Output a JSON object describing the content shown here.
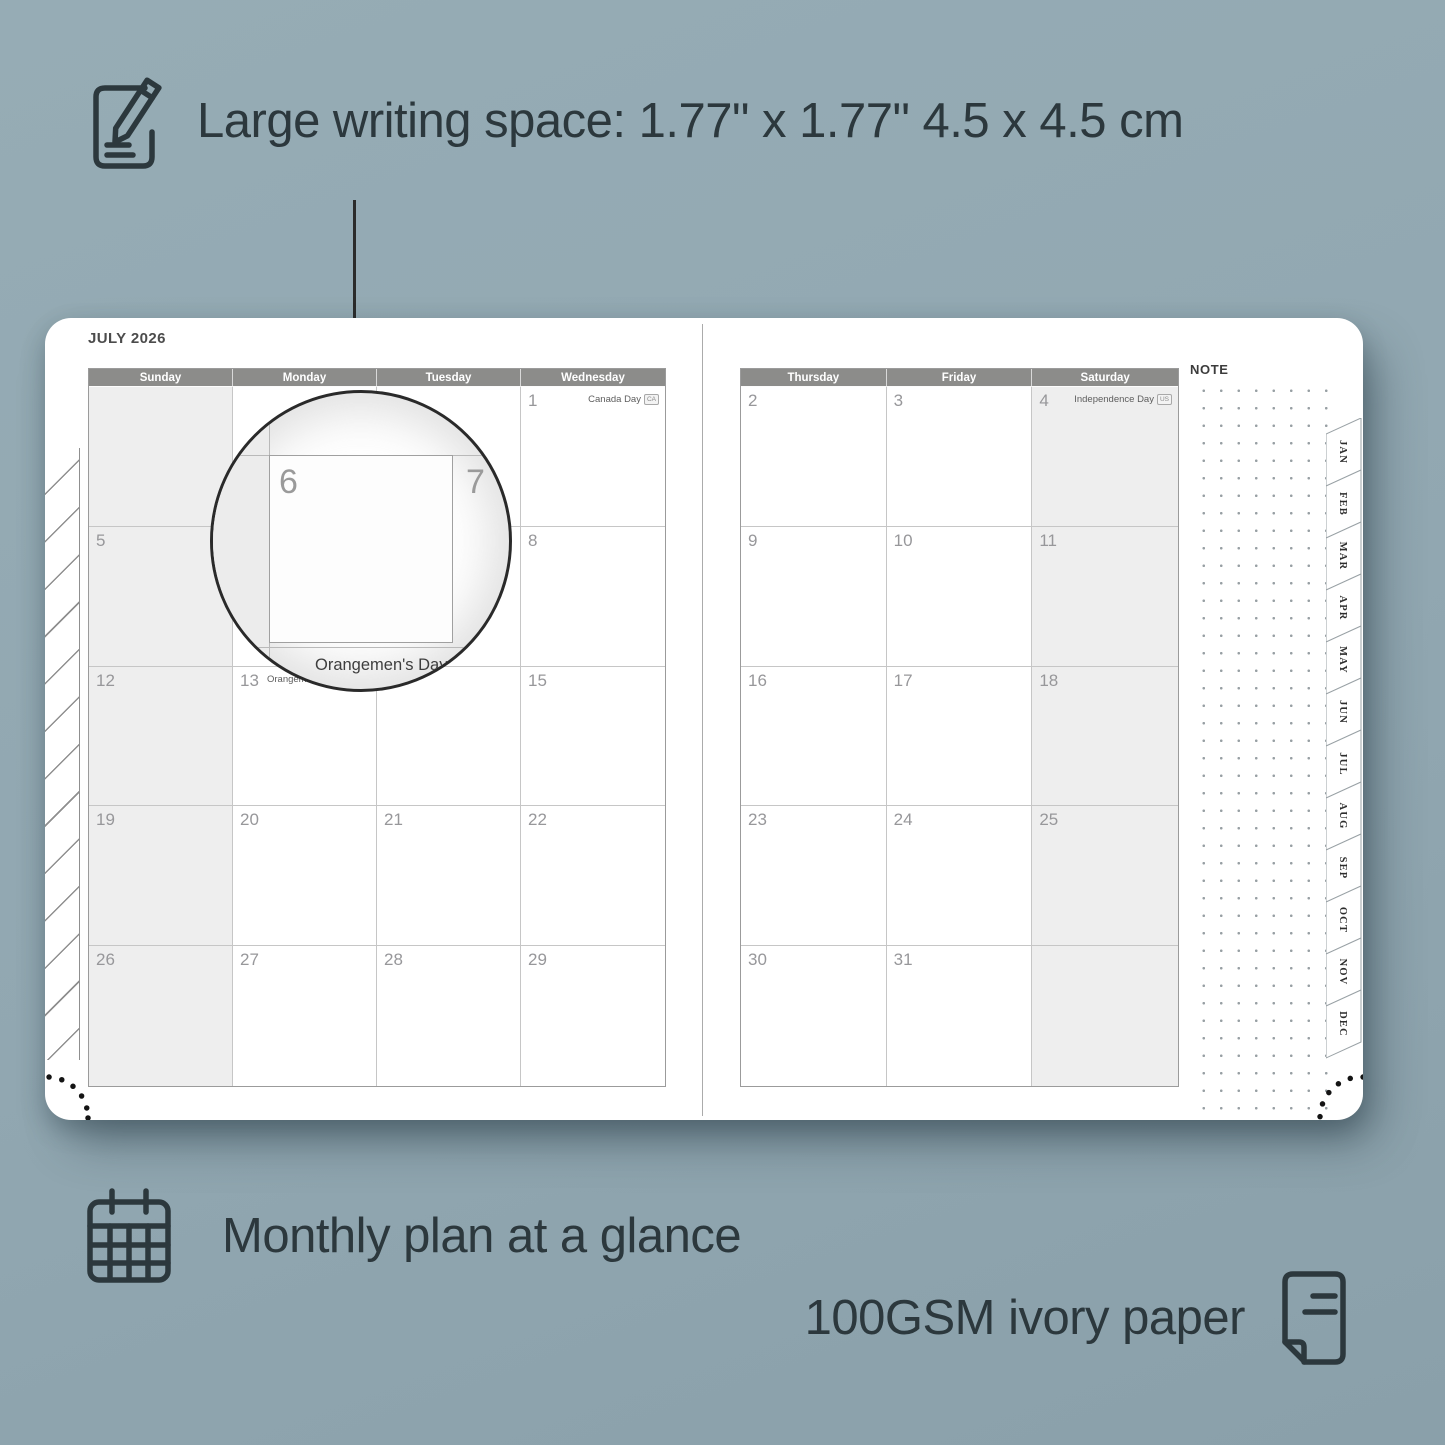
{
  "colors": {
    "background": "#91a7b1",
    "page": "#ffffff",
    "header_bar": "#8c8c8a",
    "shaded_cell": "#eeeeee",
    "grid_line": "#c6c6c6",
    "annotation_text": "#2c383d",
    "day_number": "#97979a"
  },
  "annotations": {
    "writing_space": "Large writing space: 1.77\" x 1.77\" 4.5 x 4.5 cm",
    "monthly_plan": "Monthly plan at a glance",
    "paper": "100GSM ivory paper"
  },
  "planner": {
    "month_title": "JULY 2026",
    "note_label": "NOTE",
    "left_page": {
      "day_headers": [
        "Sunday",
        "Monday",
        "Tuesday",
        "Wednesday"
      ],
      "shaded_col": 0,
      "rows": [
        [
          {
            "day": ""
          },
          {
            "day": ""
          },
          {
            "day": ""
          },
          {
            "day": "1",
            "holiday": "Canada Day",
            "badge": "CA",
            "holiday_pos": "right"
          }
        ],
        [
          {
            "day": "5"
          },
          {
            "day": "6"
          },
          {
            "day": "7"
          },
          {
            "day": "8"
          }
        ],
        [
          {
            "day": "12"
          },
          {
            "day": "13",
            "holiday": "Orangemen's Day (n.i.)",
            "badge": "UK",
            "holiday_pos": "left"
          },
          {
            "day": "14"
          },
          {
            "day": "15"
          }
        ],
        [
          {
            "day": "19"
          },
          {
            "day": "20"
          },
          {
            "day": "21"
          },
          {
            "day": "22"
          }
        ],
        [
          {
            "day": "26"
          },
          {
            "day": "27"
          },
          {
            "day": "28"
          },
          {
            "day": "29"
          }
        ]
      ]
    },
    "right_page": {
      "day_headers": [
        "Thursday",
        "Friday",
        "Saturday"
      ],
      "shaded_col": 2,
      "rows": [
        [
          {
            "day": "2"
          },
          {
            "day": "3"
          },
          {
            "day": "4",
            "holiday": "Independence Day",
            "badge": "US",
            "holiday_pos": "right"
          }
        ],
        [
          {
            "day": "9"
          },
          {
            "day": "10"
          },
          {
            "day": "11"
          }
        ],
        [
          {
            "day": "16"
          },
          {
            "day": "17"
          },
          {
            "day": "18"
          }
        ],
        [
          {
            "day": "23"
          },
          {
            "day": "24"
          },
          {
            "day": "25"
          }
        ],
        [
          {
            "day": "30"
          },
          {
            "day": "31"
          },
          {
            "day": ""
          }
        ]
      ]
    },
    "month_tabs": [
      "JAN",
      "FEB",
      "MAR",
      "APR",
      "MAY",
      "JUN",
      "JUL",
      "AUG",
      "SEP",
      "OCT",
      "NOV",
      "DEC"
    ]
  },
  "magnifier": {
    "day_left": "6",
    "day_right": "7",
    "zoom_day": "13",
    "zoom_holiday": "Orangemen's Day (n.i.)",
    "zoom_badge": "UK"
  }
}
